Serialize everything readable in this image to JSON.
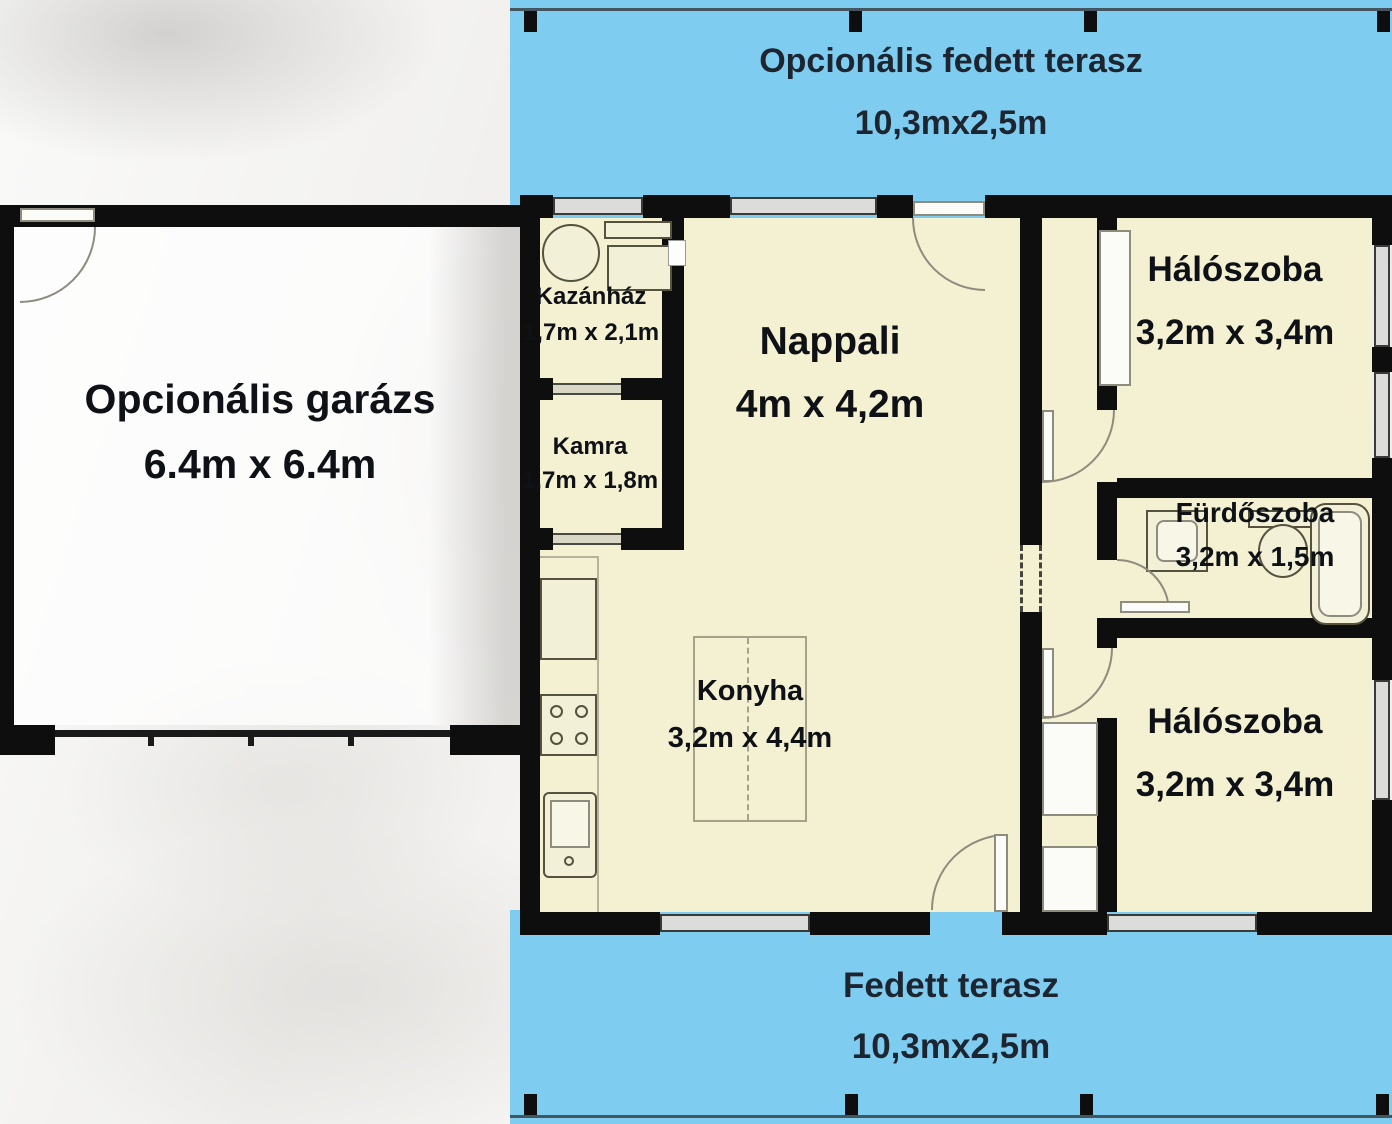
{
  "colors": {
    "terrace_blue": "#7ECDF1",
    "room_cream": "#F4F0D2",
    "wall_black": "#0e0e0e",
    "marble_white": "#F2F1EF",
    "window_gray": "#DCDCDA",
    "label_dark": "#0e1116"
  },
  "terraces": {
    "top": {
      "label": "Opcionális fedett terasz",
      "size": "10,3mx2,5m"
    },
    "bottom": {
      "label": "Fedett terasz",
      "size": "10,3mx2,5m"
    }
  },
  "garage": {
    "label": "Opcionális garázs",
    "size": "6.4m x 6.4m"
  },
  "rooms": [
    {
      "name": "Kazánház",
      "size": "1,7m x 2,1m"
    },
    {
      "name": "Kamra",
      "size": "1,7m x 1,8m"
    },
    {
      "name": "Nappali",
      "size": "4m x 4,2m"
    },
    {
      "name": "Konyha",
      "size": "3,2m x 4,4m"
    },
    {
      "name": "Hálószoba",
      "size": "3,2m x 3,4m"
    },
    {
      "name": "Fürdőszoba",
      "size": "3,2m x 1,5m"
    },
    {
      "name": "Hálószoba",
      "size": "3,2m x 3,4m"
    }
  ]
}
